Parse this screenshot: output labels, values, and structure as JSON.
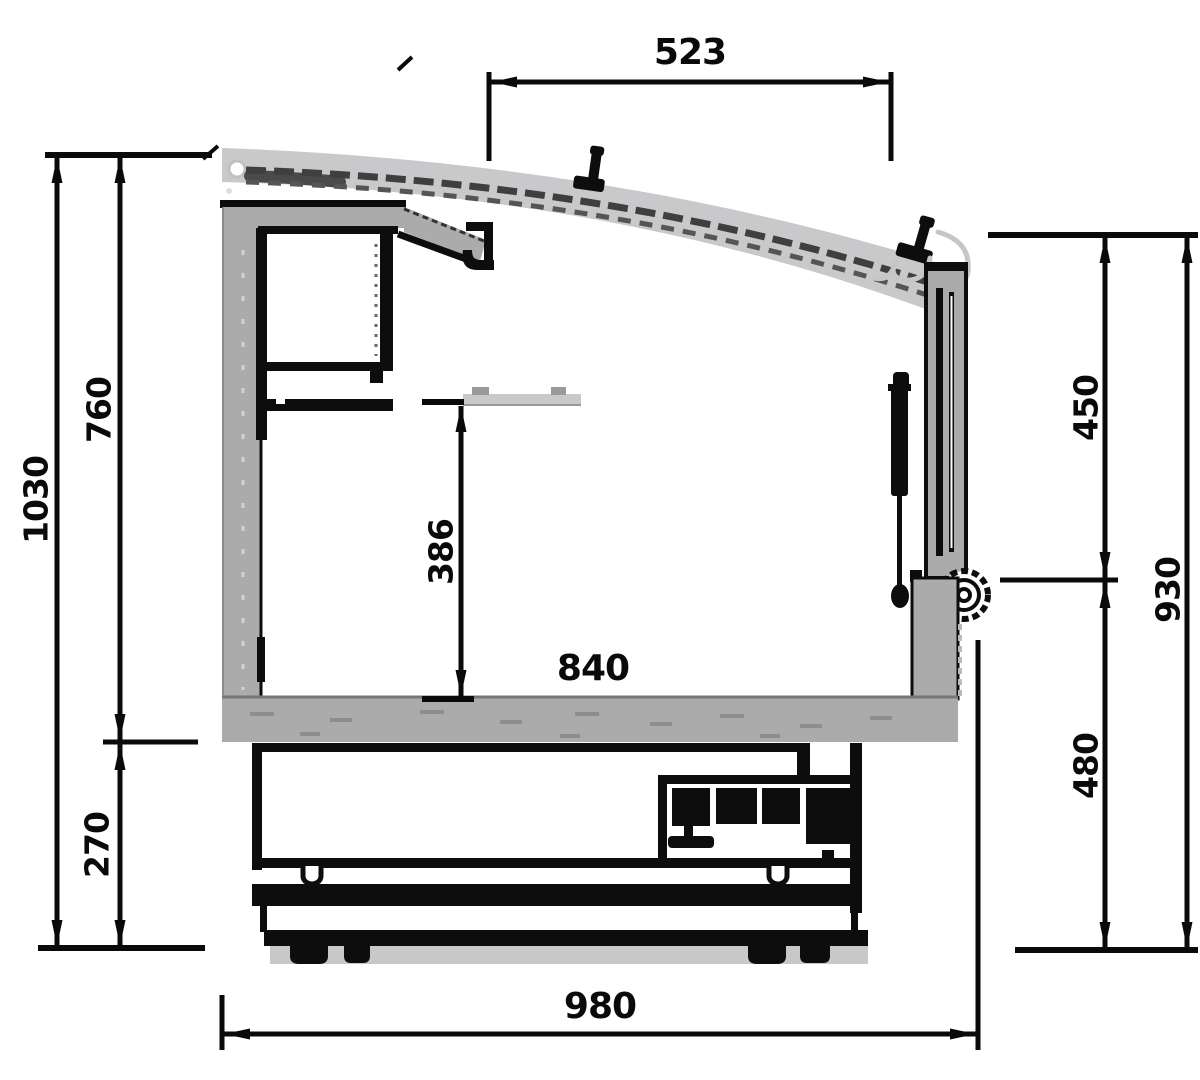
{
  "diagram": {
    "type": "technical cross-section drawing",
    "subject": "refrigerated serve-over display counter, side section with dimensions",
    "units": "mm (implied, unlabeled)",
    "dimensions": {
      "top_glass_width": "523",
      "overall_height": "1030",
      "upper_section_height": "760",
      "base_section_height": "270",
      "well_depth": "386",
      "interior_width": "840",
      "front_glass_height": "450",
      "front_overall_height": "930",
      "front_lower_height": "480",
      "overall_depth": "980"
    },
    "colors": {
      "line": "#0d0d0d",
      "panel_gray": "#ababab",
      "glass_gray": "#c9c9cc",
      "base_plate_gray": "#c8c8c8",
      "background": "#ffffff"
    }
  }
}
